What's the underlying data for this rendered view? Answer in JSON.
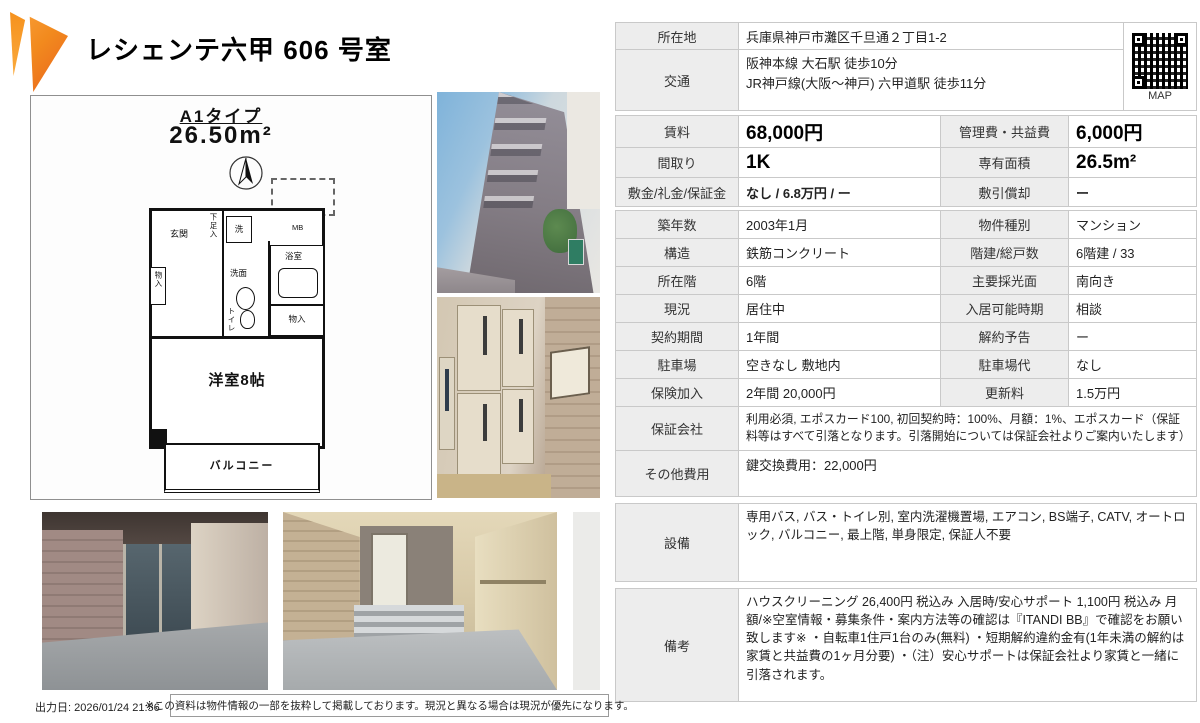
{
  "header": {
    "title": "レシェンテ六甲 606 号室"
  },
  "floorplan": {
    "type_label": "A1タイプ",
    "area_label": "26.50m²",
    "rooms": {
      "entrance": "玄関",
      "shoe_box": "下足入",
      "washer": "洗",
      "meter_box": "MB",
      "storage_left": "物入",
      "washroom": "洗面",
      "bathroom": "浴室",
      "toilet": "トイレ",
      "storage_right": "物入",
      "main_room": "洋室8帖",
      "balcony": "バルコニー"
    }
  },
  "map": {
    "label": "MAP"
  },
  "table": {
    "location": {
      "label": "所在地",
      "value": "兵庫県神戸市灘区千旦通２丁目1-2"
    },
    "access": {
      "label": "交通",
      "lines": [
        "阪神本線 大石駅 徒歩10分",
        "JR神戸線(大阪〜神戸) 六甲道駅 徒歩11分"
      ]
    },
    "rent": {
      "label": "賃料",
      "value": "68,000円"
    },
    "mgmt_fee": {
      "label": "管理費・共益費",
      "value": "6,000円"
    },
    "layout": {
      "label": "間取り",
      "value": "1K"
    },
    "area": {
      "label": "専有面積",
      "value": "26.5m²"
    },
    "deposit": {
      "label": "敷金/礼金/保証金",
      "value": "なし / 6.8万円 / ー"
    },
    "amortization": {
      "label": "敷引償却",
      "value": "ー"
    },
    "built": {
      "label": "築年数",
      "value": "2003年1月"
    },
    "category": {
      "label": "物件種別",
      "value": "マンション"
    },
    "structure": {
      "label": "構造",
      "value": "鉄筋コンクリート"
    },
    "floors_units": {
      "label": "階建/総戸数",
      "value": "6階建 / 33"
    },
    "floor": {
      "label": "所在階",
      "value": "6階"
    },
    "facing": {
      "label": "主要採光面",
      "value": "南向き"
    },
    "status": {
      "label": "現況",
      "value": "居住中"
    },
    "move_in": {
      "label": "入居可能時期",
      "value": "相談"
    },
    "term": {
      "label": "契約期間",
      "value": "1年間"
    },
    "notice": {
      "label": "解約予告",
      "value": "ー"
    },
    "parking": {
      "label": "駐車場",
      "value": "空きなし 敷地内"
    },
    "parking_fee": {
      "label": "駐車場代",
      "value": "なし"
    },
    "insurance": {
      "label": "保険加入",
      "value": "2年間 20,000円"
    },
    "renewal_fee": {
      "label": "更新料",
      "value": "1.5万円"
    },
    "guarantor": {
      "label": "保証会社",
      "value": "利用必須, エポスカード100, 初回契約時：100%、月額：1%、エポスカード（保証料等はすべて引落となります。引落開始については保証会社よりご案内いたします）"
    },
    "other_fees": {
      "label": "その他費用",
      "value": "鍵交換費用：22,000円"
    },
    "equipment": {
      "label": "設備",
      "value": "専用バス, バス・トイレ別, 室内洗濯機置場, エアコン, BS端子, CATV, オートロック, バルコニー, 最上階, 単身限定, 保証人不要"
    },
    "remarks": {
      "label": "備考",
      "value": "ハウスクリーニング 26,400円 税込み 入居時/安心サポート 1,100円 税込み 月額/※空室情報・募集条件・案内方法等の確認は『ITANDI BB』で確認をお願い致します※ ・自転車1住戸1台のみ(無料) ・短期解約違約金有(1年未満の解約は家賃と共益費の1ヶ月分要) ・（注）安心サポートは保証会社より家賃と一緒に引落されます。"
    }
  },
  "footer": {
    "output_date": "出力日: 2026/01/24 21:56",
    "note": "※この資料は物件情報の一部を抜粋して掲載しております。現況と異なる場合は現況が優先になります。"
  },
  "colors": {
    "accent_orange": "#f6921e",
    "accent_orange_dark": "#e9621c",
    "label_bg": "#ededed",
    "table_border": "#c9c9c9"
  }
}
